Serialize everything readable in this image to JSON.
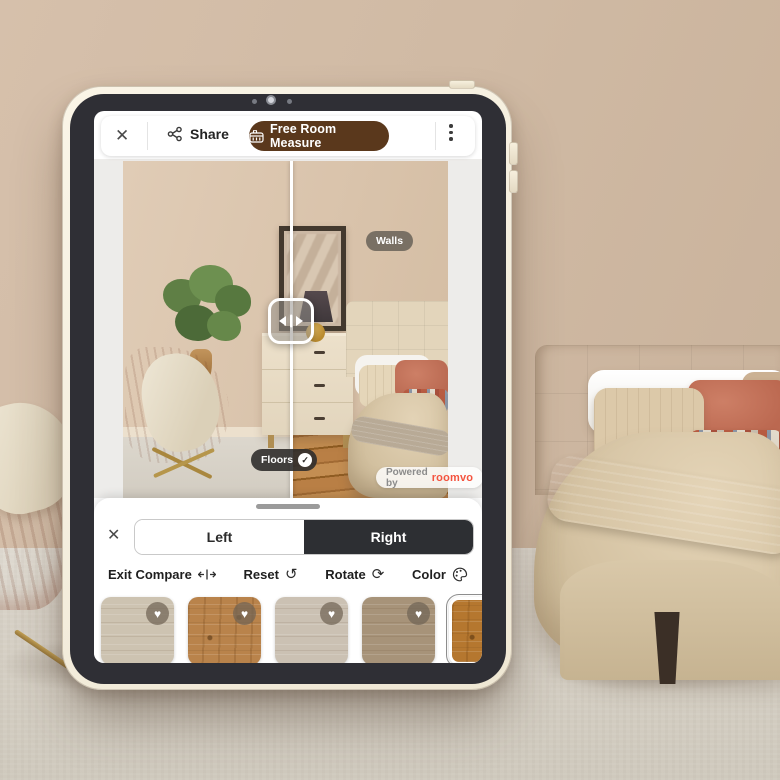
{
  "topbar": {
    "close_icon": "✕",
    "share_label": "Share",
    "measure_button_label": "Free Room Measure",
    "measure_button_color": "#5a381c",
    "menu_icon": "⋮"
  },
  "viewer": {
    "walls_tag": "Walls",
    "floors_tag": "Floors",
    "check_icon": "✓",
    "powered_by_label": "Powered by",
    "brand_name": "roomvo",
    "brand_color": "#f4533e",
    "compare_handle_icon": "split-arrows"
  },
  "panel": {
    "close_icon": "✕",
    "tabs": [
      {
        "label": "Left",
        "selected": false
      },
      {
        "label": "Right",
        "selected": true
      }
    ],
    "selected_tab_color": "#2d2f33",
    "tools": [
      {
        "label": "Exit Compare",
        "icon": "compare-arrows-icon"
      },
      {
        "label": "Reset",
        "icon": "reset-icon",
        "glyph": "↺"
      },
      {
        "label": "Rotate",
        "icon": "rotate-icon",
        "glyph": "⟳"
      },
      {
        "label": "Color",
        "icon": "palette-icon"
      }
    ],
    "heart_icon": "♥",
    "swatches": [
      {
        "name": "light beige oak",
        "color": "#cdc3b1",
        "favorite": true,
        "selected": false
      },
      {
        "name": "golden oak",
        "color": "#b9834b",
        "favorite": true,
        "selected": false
      },
      {
        "name": "washed gray oak",
        "color": "#cbc1b3",
        "favorite": true,
        "selected": false
      },
      {
        "name": "taupe oak",
        "color": "#a79379",
        "favorite": true,
        "selected": false
      },
      {
        "name": "rustic honey oak",
        "color": "#b5772f",
        "favorite": false,
        "selected": true
      }
    ]
  }
}
